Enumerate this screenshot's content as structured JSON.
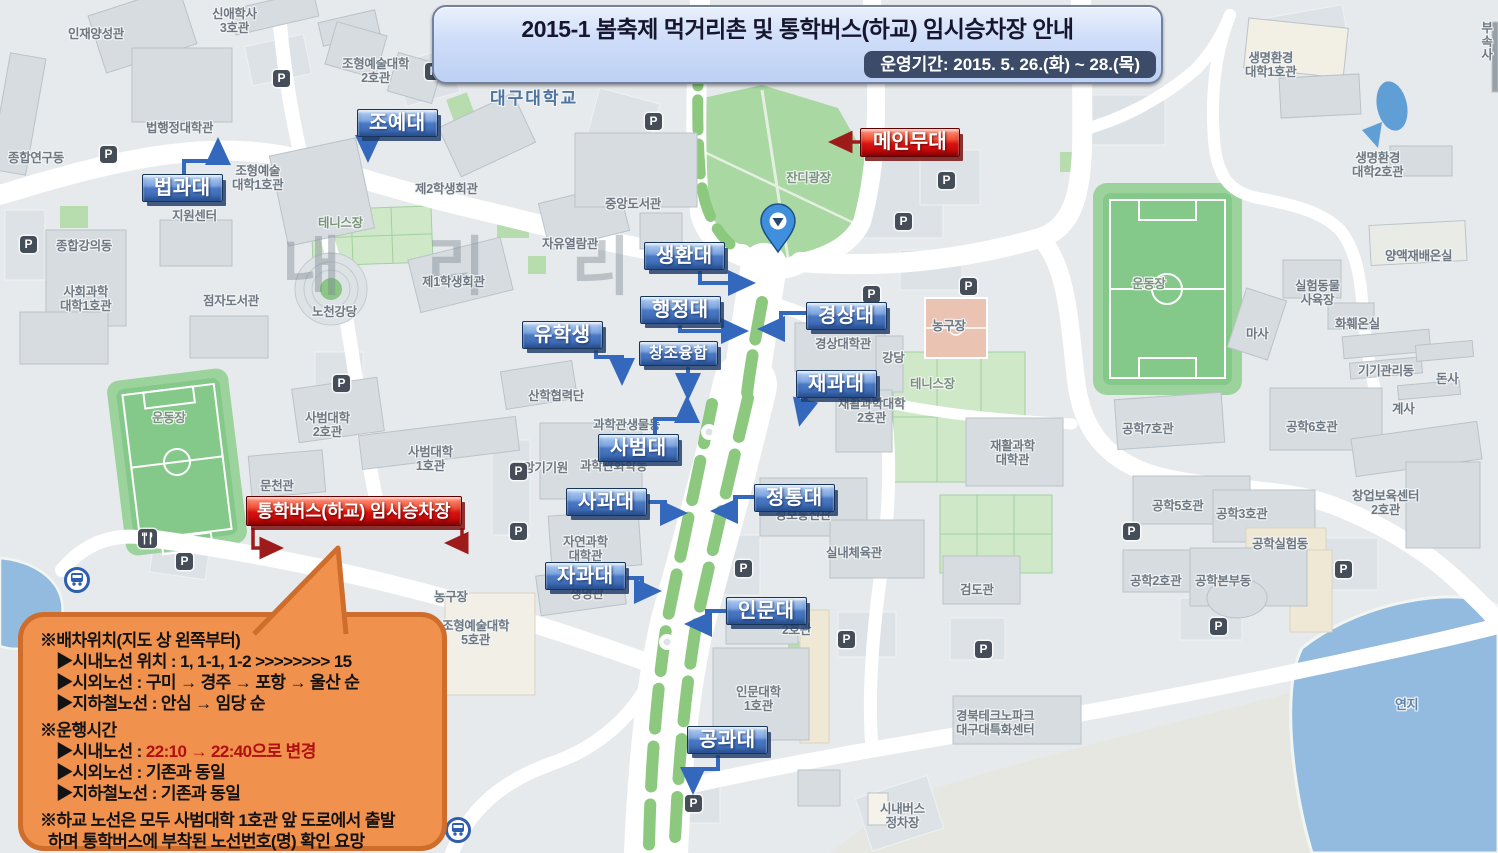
{
  "banner": {
    "title": "2015-1 봄축제 먹거리촌 및 통학버스(하교) 임시승차장 안내",
    "period": "운영기간: 2015. 5. 26.(화) ~ 28.(목)"
  },
  "stage_label": "메인무대",
  "bus_stop_label": "통학버스(하교) 임시승차장",
  "watermark": "내 리 리",
  "icons": {
    "parking": "P"
  },
  "colors": {
    "college_label_blue": "#3a6ab8",
    "notice_red": "#cc0000",
    "highlight_text_red": "#b01010",
    "bubble_orange": "#f0914e"
  },
  "college_labels": [
    "조예대",
    "법과대",
    "생환대",
    "행정대",
    "유학생",
    "창조융합",
    "경상대",
    "재과대",
    "사범대",
    "사과대",
    "정통대",
    "자과대",
    "인문대",
    "공과대"
  ],
  "map_labels": [
    "인재양성관",
    "신애학사\n3호관",
    "조형예술대학\n2호관",
    "법행정대학관",
    "종합연구동",
    "조형예술\n대학1호관",
    "제2학생회관",
    "지원센터",
    "테니스장",
    "종합강의동",
    "자유열람관",
    "중앙도서관",
    "사회과학\n대학1호관",
    "점자도서관",
    "노천강당",
    "제1학생회관",
    "대구대학교",
    "잔디광장",
    "경상대학관",
    "강당",
    "농구장",
    "테니스장",
    "재활과학대학\n2호관",
    "재활과학\n대학관",
    "운동장",
    "마사",
    "양액재배온실",
    "실험동물\n사육장",
    "화훼온실",
    "기기관리동",
    "돈사",
    "계사",
    "생명환경\n대학1호관",
    "생명환경\n대학2호관",
    "부속\n사",
    "공학7호관",
    "공학6호관",
    "공학5호관",
    "공학3호관",
    "공학실험동",
    "창업보육센터\n2호관",
    "공학2호관",
    "공학본부동",
    "운동장",
    "문천관",
    "사범대학\n2호관",
    "산학협력단",
    "사범대학\n1호관",
    "중앙기기원",
    "과학관생물동",
    "과학관화학동",
    "자연과학\n대학관",
    "생명관",
    "정보통신관",
    "실내체육관",
    "검도관",
    "2호관",
    "인문대학\n1호관",
    "조형예술대학\n5호관",
    "농구장",
    "경북테크노파크\n대구대특화센터",
    "시내버스\n정차장",
    "연지"
  ],
  "info_bubble": {
    "section1_title": "※배차위치(지도 상 왼쪽부터)",
    "section1_items": [
      "▶시내노선 위치 : 1, 1-1, 1-2 >>>>>>>> 15",
      "▶시외노선 : 구미 → 경주 → 포항 → 울산 순",
      "▶지하철노선 : 안심 → 임당 순"
    ],
    "section2_title": "※운행시간",
    "section2_item1_label": "▶시내노선 : ",
    "section2_item1_highlight": "22:10 → 22:40으로 변경",
    "section2_items": [
      "▶시외노선 : 기존과 동일",
      "▶지하철노선 : 기존과 동일"
    ],
    "footer1": "※하교 노선은 모두 사범대학 1호관 앞 도로에서 출발",
    "footer2": "하며 통학버스에 부착된 노선번호(명) 확인 요망"
  }
}
